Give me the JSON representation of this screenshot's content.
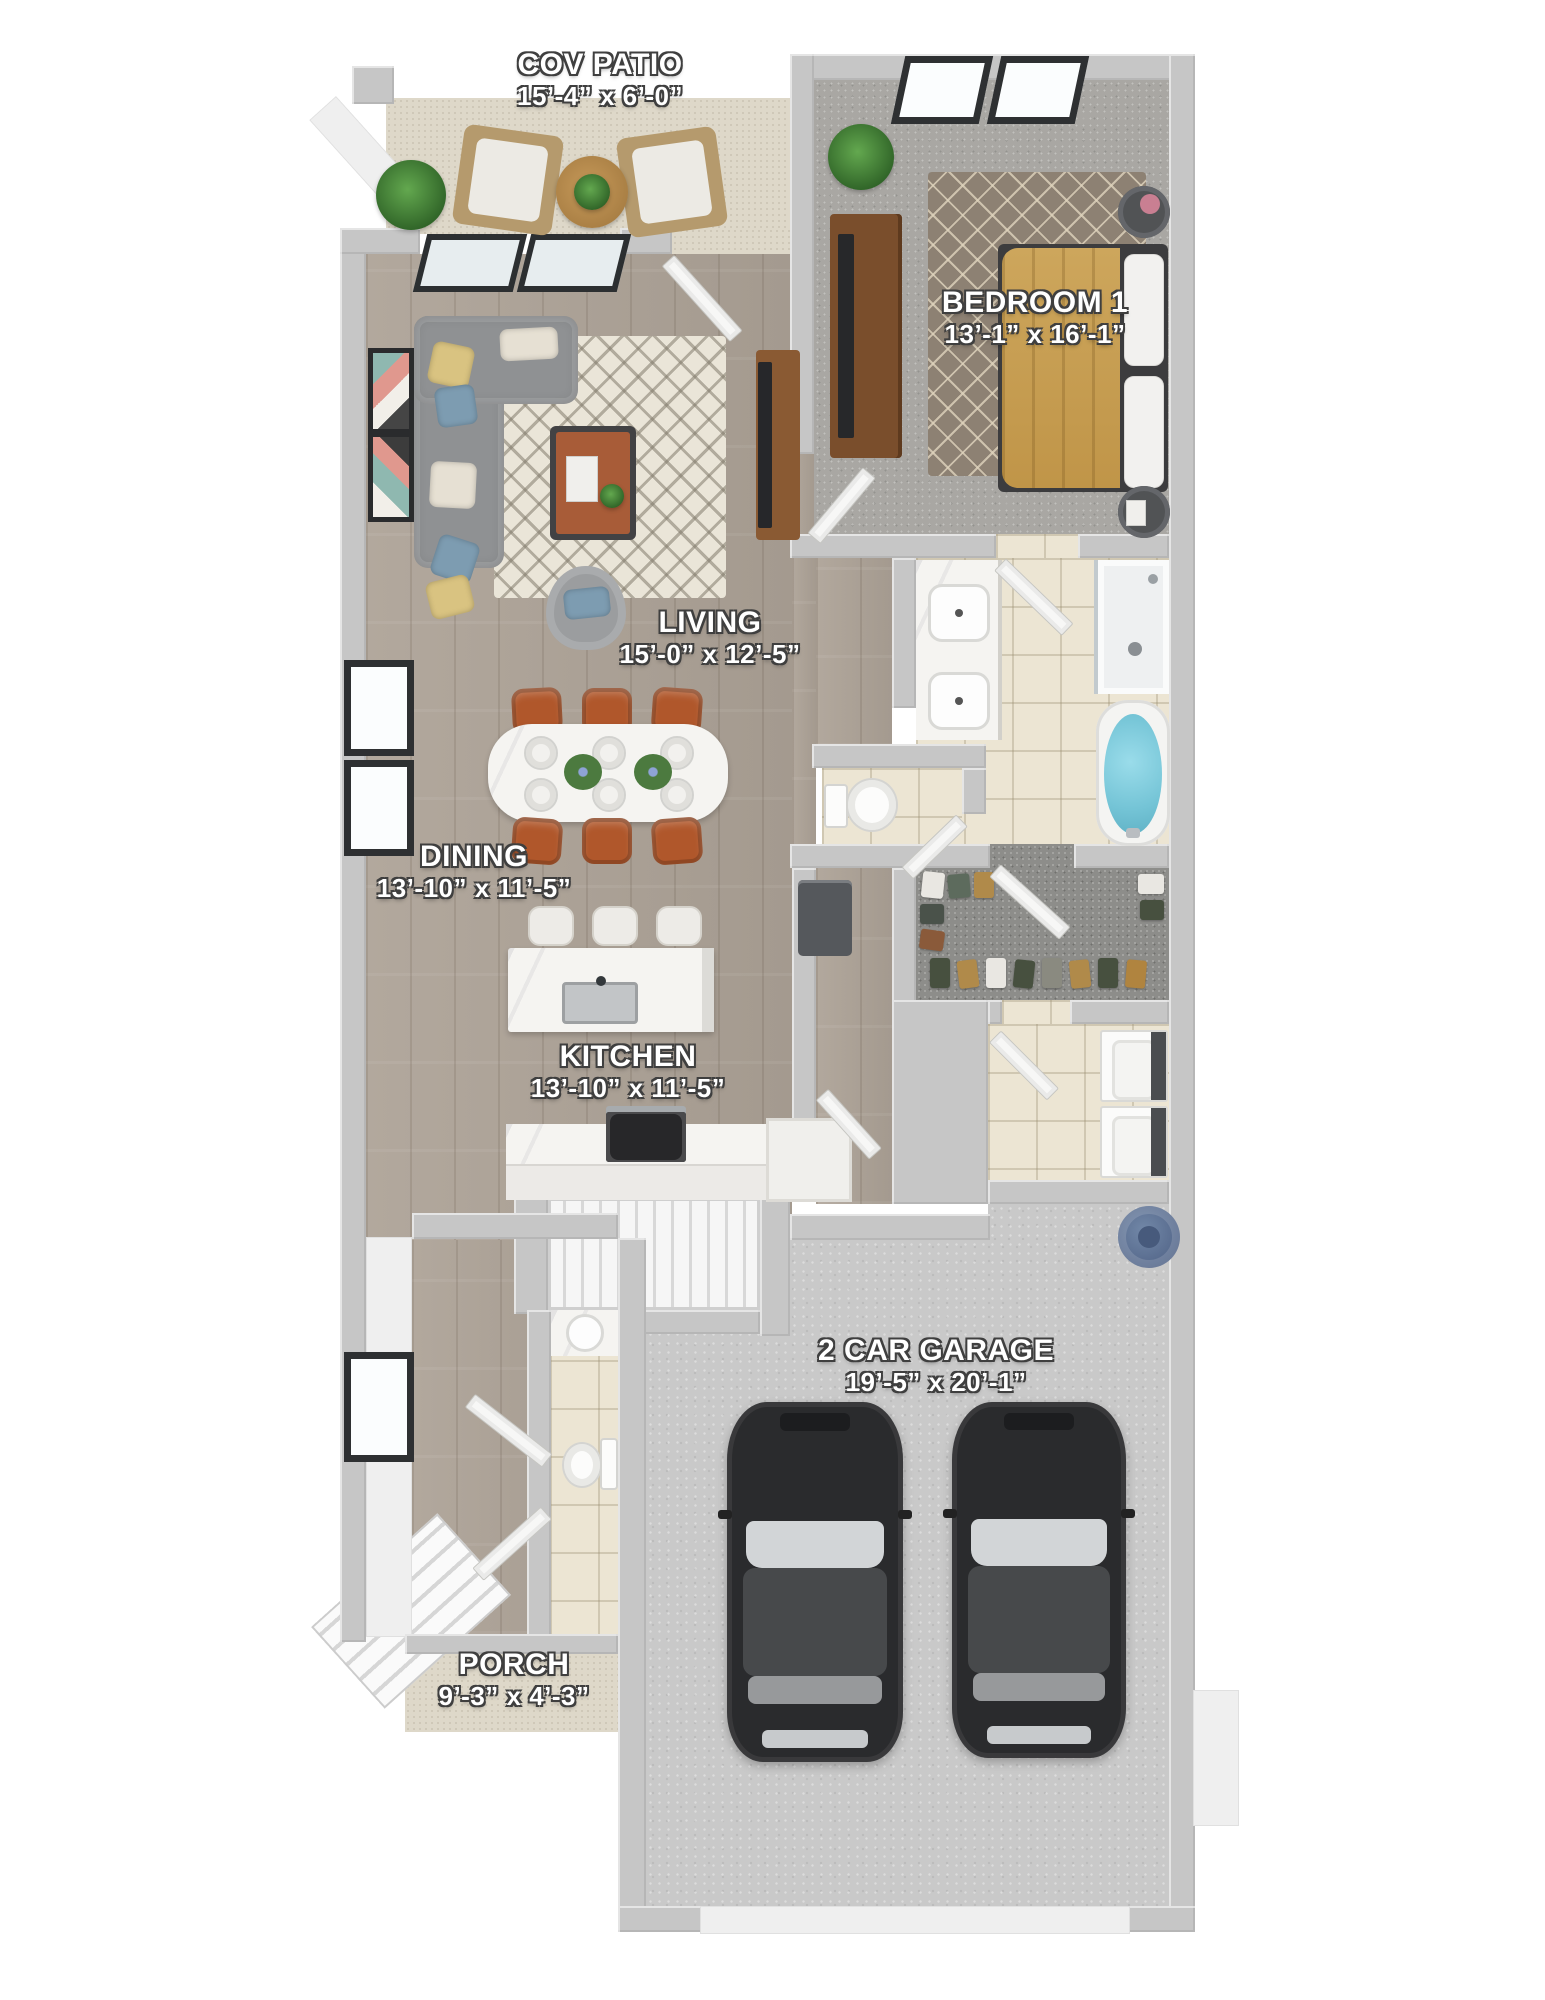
{
  "plan": {
    "type": "3d-floor-plan",
    "rooms": [
      {
        "id": "cov-patio",
        "name": "COV PATIO",
        "dims": "15’-4” x 6’-0”"
      },
      {
        "id": "bedroom-1",
        "name": "BEDROOM 1",
        "dims": "13’-1” x 16’-1”"
      },
      {
        "id": "living",
        "name": "LIVING",
        "dims": "15’-0” x 12’-5”"
      },
      {
        "id": "dining",
        "name": "DINING",
        "dims": "13’-10” x 11’-5”"
      },
      {
        "id": "kitchen",
        "name": "KITCHEN",
        "dims": "13’-10” x 11’-5”"
      },
      {
        "id": "garage",
        "name": "2 CAR GARAGE",
        "dims": "19’-5” x 20’-1”"
      },
      {
        "id": "porch",
        "name": "PORCH",
        "dims": "9’-3” x 4’-3”"
      }
    ],
    "colors": {
      "wall": "#c6c6c6",
      "wood_floor": "#aba196",
      "bedroom_carpet": "#a9a7a3",
      "closet_carpet": "#8d8d8a",
      "tile": "#ece5d3",
      "patio_porch": "#ded8c9",
      "garage_concrete": "#c9c9c9",
      "dining_chair_rust": "#b0572b",
      "bed_duvet": "#c9a255",
      "tub_water": "#74c4d6",
      "car_body": "#2a2b2d",
      "water_heater": "#56688a"
    }
  }
}
